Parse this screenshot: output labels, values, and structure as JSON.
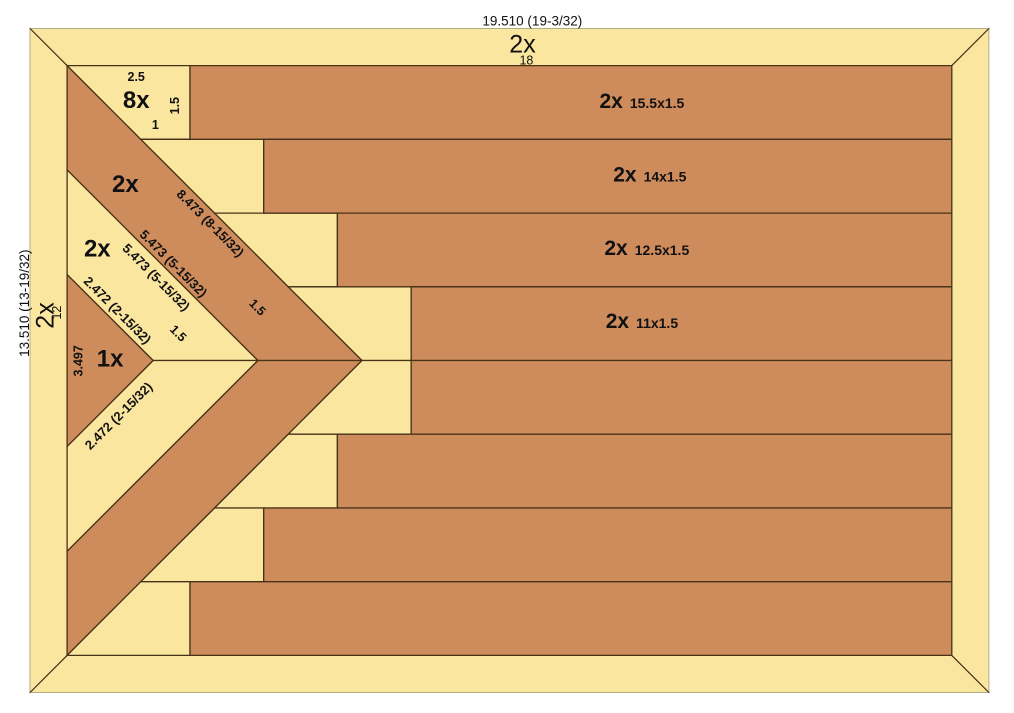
{
  "colors": {
    "light_wood": "#FBE6A0",
    "dark_wood": "#CE8C5C",
    "outline": "#463217",
    "frame_edge": "#b3ac85",
    "text": "#111111",
    "background": "#ffffff"
  },
  "diagram": {
    "kind": "wood flag cutting diagram",
    "pieces": [
      {
        "name": "frame-top-rail",
        "fill": "light_wood",
        "frame": true,
        "points": [
          [
            0,
            0
          ],
          [
            19.51,
            0
          ],
          [
            18.755,
            0.755
          ],
          [
            0.755,
            0.755
          ]
        ]
      },
      {
        "name": "frame-bottom-rail",
        "fill": "light_wood",
        "frame": true,
        "points": [
          [
            0,
            13.51
          ],
          [
            19.51,
            13.51
          ],
          [
            18.755,
            12.755
          ],
          [
            0.755,
            12.755
          ]
        ]
      },
      {
        "name": "frame-left-stile",
        "fill": "light_wood",
        "frame": true,
        "points": [
          [
            0,
            0
          ],
          [
            0.755,
            0.755
          ],
          [
            0.755,
            12.755
          ],
          [
            0,
            13.51
          ]
        ]
      },
      {
        "name": "frame-right-stile",
        "fill": "light_wood",
        "frame": true,
        "points": [
          [
            19.51,
            0
          ],
          [
            18.755,
            0.755
          ],
          [
            18.755,
            12.755
          ],
          [
            19.51,
            13.51
          ]
        ]
      },
      {
        "name": "chevron-outer-upper-leg",
        "fill": "dark_wood",
        "points": [
          [
            0.755,
            0.755
          ],
          [
            6.755,
            6.755
          ],
          [
            4.634,
            6.755
          ],
          [
            0.755,
            2.876
          ]
        ]
      },
      {
        "name": "chevron-outer-lower-leg",
        "fill": "dark_wood",
        "points": [
          [
            0.755,
            12.755
          ],
          [
            6.755,
            6.755
          ],
          [
            4.634,
            6.755
          ],
          [
            0.755,
            10.634
          ]
        ]
      },
      {
        "name": "chevron-inner-upper-leg",
        "fill": "light_wood",
        "points": [
          [
            0.755,
            2.876
          ],
          [
            4.634,
            6.755
          ],
          [
            2.504,
            6.755
          ],
          [
            0.755,
            5.007
          ]
        ]
      },
      {
        "name": "chevron-inner-lower-leg",
        "fill": "light_wood",
        "points": [
          [
            0.755,
            10.634
          ],
          [
            4.634,
            6.755
          ],
          [
            2.504,
            6.755
          ],
          [
            0.755,
            8.503
          ]
        ]
      },
      {
        "name": "center-triangle",
        "fill": "dark_wood",
        "points": [
          [
            0.755,
            5.007
          ],
          [
            2.504,
            6.755
          ],
          [
            0.755,
            8.503
          ]
        ]
      },
      {
        "name": "filler-trapezoid-row1",
        "fill": "light_wood",
        "points": [
          [
            0.755,
            0.755
          ],
          [
            3.255,
            0.755
          ],
          [
            3.255,
            2.255
          ],
          [
            2.255,
            2.255
          ]
        ]
      },
      {
        "name": "filler-trapezoid-row2",
        "fill": "light_wood",
        "points": [
          [
            2.255,
            2.255
          ],
          [
            4.755,
            2.255
          ],
          [
            4.755,
            3.755
          ],
          [
            3.755,
            3.755
          ]
        ]
      },
      {
        "name": "filler-trapezoid-row3",
        "fill": "light_wood",
        "points": [
          [
            3.755,
            3.755
          ],
          [
            6.255,
            3.755
          ],
          [
            6.255,
            5.255
          ],
          [
            5.255,
            5.255
          ]
        ]
      },
      {
        "name": "filler-trapezoid-row4",
        "fill": "light_wood",
        "points": [
          [
            5.255,
            5.255
          ],
          [
            7.755,
            5.255
          ],
          [
            7.755,
            6.755
          ],
          [
            6.755,
            6.755
          ]
        ]
      },
      {
        "name": "filler-trapezoid-row5",
        "fill": "light_wood",
        "points": [
          [
            5.255,
            8.255
          ],
          [
            7.755,
            8.255
          ],
          [
            7.755,
            6.755
          ],
          [
            6.755,
            6.755
          ]
        ]
      },
      {
        "name": "filler-trapezoid-row6",
        "fill": "light_wood",
        "points": [
          [
            3.755,
            9.755
          ],
          [
            6.255,
            9.755
          ],
          [
            6.255,
            8.255
          ],
          [
            5.255,
            8.255
          ]
        ]
      },
      {
        "name": "filler-trapezoid-row7",
        "fill": "light_wood",
        "points": [
          [
            2.255,
            11.255
          ],
          [
            4.755,
            11.255
          ],
          [
            4.755,
            9.755
          ],
          [
            3.755,
            9.755
          ]
        ]
      },
      {
        "name": "filler-trapezoid-row8",
        "fill": "light_wood",
        "points": [
          [
            0.755,
            12.755
          ],
          [
            3.255,
            12.755
          ],
          [
            3.255,
            11.255
          ],
          [
            2.255,
            11.255
          ]
        ]
      },
      {
        "name": "stripe-row1",
        "fill": "dark_wood",
        "points": [
          [
            3.255,
            0.755
          ],
          [
            18.755,
            0.755
          ],
          [
            18.755,
            2.255
          ],
          [
            3.255,
            2.255
          ]
        ]
      },
      {
        "name": "stripe-row2",
        "fill": "dark_wood",
        "points": [
          [
            4.755,
            2.255
          ],
          [
            18.755,
            2.255
          ],
          [
            18.755,
            3.755
          ],
          [
            4.755,
            3.755
          ]
        ]
      },
      {
        "name": "stripe-row3",
        "fill": "dark_wood",
        "points": [
          [
            6.255,
            3.755
          ],
          [
            18.755,
            3.755
          ],
          [
            18.755,
            5.255
          ],
          [
            6.255,
            5.255
          ]
        ]
      },
      {
        "name": "stripe-row4",
        "fill": "dark_wood",
        "points": [
          [
            7.755,
            5.255
          ],
          [
            18.755,
            5.255
          ],
          [
            18.755,
            6.755
          ],
          [
            7.755,
            6.755
          ]
        ]
      },
      {
        "name": "stripe-row5",
        "fill": "dark_wood",
        "points": [
          [
            7.755,
            8.255
          ],
          [
            18.755,
            8.255
          ],
          [
            18.755,
            6.755
          ],
          [
            7.755,
            6.755
          ]
        ]
      },
      {
        "name": "stripe-row6",
        "fill": "dark_wood",
        "points": [
          [
            6.255,
            9.755
          ],
          [
            18.755,
            9.755
          ],
          [
            18.755,
            8.255
          ],
          [
            6.255,
            8.255
          ]
        ]
      },
      {
        "name": "stripe-row7",
        "fill": "dark_wood",
        "points": [
          [
            4.755,
            11.255
          ],
          [
            18.755,
            11.255
          ],
          [
            18.755,
            9.755
          ],
          [
            4.755,
            9.755
          ]
        ]
      },
      {
        "name": "stripe-row8",
        "fill": "dark_wood",
        "points": [
          [
            3.255,
            12.755
          ],
          [
            18.755,
            12.755
          ],
          [
            18.755,
            11.255
          ],
          [
            3.255,
            11.255
          ]
        ]
      }
    ],
    "miter_joints": [
      {
        "name": "miter-top-left",
        "from": [
          0,
          0
        ],
        "to": [
          0.755,
          0.755
        ]
      },
      {
        "name": "miter-top-right",
        "from": [
          19.51,
          0
        ],
        "to": [
          18.755,
          0.755
        ]
      },
      {
        "name": "miter-bottom-left",
        "from": [
          0,
          13.51
        ],
        "to": [
          0.755,
          12.755
        ]
      },
      {
        "name": "miter-bottom-right",
        "from": [
          19.51,
          13.51
        ],
        "to": [
          18.755,
          12.755
        ]
      }
    ],
    "labels": [
      {
        "name": "dim-overall-width",
        "text": "19.510 (19-3/32)",
        "x": 10.22,
        "y": -0.16,
        "rot": 0,
        "size": 13.5,
        "weight": 400
      },
      {
        "name": "qty-top-rail",
        "text": "2x",
        "x": 10.02,
        "y": 0.31,
        "rot": 0,
        "size": 25,
        "weight": 400
      },
      {
        "name": "len-top-rail",
        "text": "18",
        "x": 10.1,
        "y": 0.64,
        "rot": 0,
        "size": 12.5,
        "weight": 400
      },
      {
        "name": "dim-overall-height",
        "text": "13.510 (13-19/32)",
        "x": -0.12,
        "y": 5.59,
        "rot": -90,
        "size": 13.5,
        "weight": 400
      },
      {
        "name": "qty-left-stile",
        "text": "2x",
        "x": 0.3,
        "y": 5.84,
        "rot": -90,
        "size": 25,
        "weight": 400
      },
      {
        "name": "len-left-stile",
        "text": "12",
        "x": 0.54,
        "y": 5.78,
        "rot": -90,
        "size": 12.5,
        "weight": 400
      },
      {
        "name": "dim-trapezoid-top",
        "text": "2.5",
        "x": 2.16,
        "y": 0.98,
        "rot": 0,
        "size": 12.5,
        "weight": 700
      },
      {
        "name": "qty-filler-trapezoid",
        "text": "8x",
        "x": 2.16,
        "y": 1.45,
        "rot": 0,
        "size": 24,
        "weight": 700
      },
      {
        "name": "dim-trapezoid-right",
        "text": "1.5",
        "x": 2.94,
        "y": 1.57,
        "rot": -90,
        "size": 12.5,
        "weight": 700
      },
      {
        "name": "dim-trapezoid-bottom",
        "text": "1",
        "x": 2.55,
        "y": 1.96,
        "rot": 0,
        "size": 12.5,
        "weight": 700
      },
      {
        "name": "qty-outer-chevron",
        "text": "2x",
        "x": 1.94,
        "y": 3.16,
        "rot": 0,
        "size": 24,
        "weight": 700
      },
      {
        "name": "dim-outer-chevron-long-edge",
        "text": "8.473 (8-15/32)",
        "x": 3.67,
        "y": 3.96,
        "rot": 45,
        "size": 13,
        "weight": 700
      },
      {
        "name": "dim-outer-chevron-short-edge",
        "text": "5.473 (5-15/32)",
        "x": 2.92,
        "y": 4.78,
        "rot": 45,
        "size": 13,
        "weight": 700
      },
      {
        "name": "dim-inner-chevron-long-edge",
        "text": "5.473 (5-15/32)",
        "x": 2.57,
        "y": 5.06,
        "rot": 45,
        "size": 13,
        "weight": 700
      },
      {
        "name": "dim-outer-chevron-width",
        "text": "1.5",
        "x": 4.63,
        "y": 5.67,
        "rot": 45,
        "size": 12.5,
        "weight": 700
      },
      {
        "name": "qty-inner-chevron",
        "text": "2x",
        "x": 1.37,
        "y": 4.47,
        "rot": 0,
        "size": 24,
        "weight": 700
      },
      {
        "name": "dim-inner-chevron-short-edge",
        "text": "2.472 (2-15/32)",
        "x": 1.78,
        "y": 5.73,
        "rot": 45,
        "size": 13,
        "weight": 700
      },
      {
        "name": "dim-inner-chevron-width",
        "text": "1.5",
        "x": 3.02,
        "y": 6.2,
        "rot": 45,
        "size": 12.5,
        "weight": 700
      },
      {
        "name": "qty-center-triangle",
        "text": "1x",
        "x": 1.63,
        "y": 6.71,
        "rot": 0,
        "size": 24,
        "weight": 700
      },
      {
        "name": "dim-triangle-height",
        "text": "3.497",
        "x": 0.98,
        "y": 6.76,
        "rot": -90,
        "size": 12.5,
        "weight": 700
      },
      {
        "name": "dim-triangle-edge",
        "text": "2.472 (2-15/32)",
        "x": 1.8,
        "y": 7.88,
        "rot": -45,
        "size": 13,
        "weight": 700
      },
      {
        "name": "stripe-label-row1",
        "x": 12.45,
        "y": 1.5,
        "rot": 0,
        "weight": 700,
        "parts": [
          {
            "text": "2x",
            "size": 21
          },
          {
            "text": "15.5x1.5",
            "size": 14,
            "dx": 7
          }
        ]
      },
      {
        "name": "stripe-label-row2",
        "x": 12.61,
        "y": 3.0,
        "rot": 0,
        "weight": 700,
        "parts": [
          {
            "text": "2x",
            "size": 21
          },
          {
            "text": "14x1.5",
            "size": 14,
            "dx": 7
          }
        ]
      },
      {
        "name": "stripe-label-row3",
        "x": 12.55,
        "y": 4.49,
        "rot": 0,
        "weight": 700,
        "parts": [
          {
            "text": "2x",
            "size": 21
          },
          {
            "text": "12.5x1.5",
            "size": 14,
            "dx": 7
          }
        ]
      },
      {
        "name": "stripe-label-row4",
        "x": 12.45,
        "y": 5.98,
        "rot": 0,
        "weight": 700,
        "parts": [
          {
            "text": "2x",
            "size": 21
          },
          {
            "text": "11x1.5",
            "size": 14,
            "dx": 7
          }
        ]
      }
    ]
  }
}
